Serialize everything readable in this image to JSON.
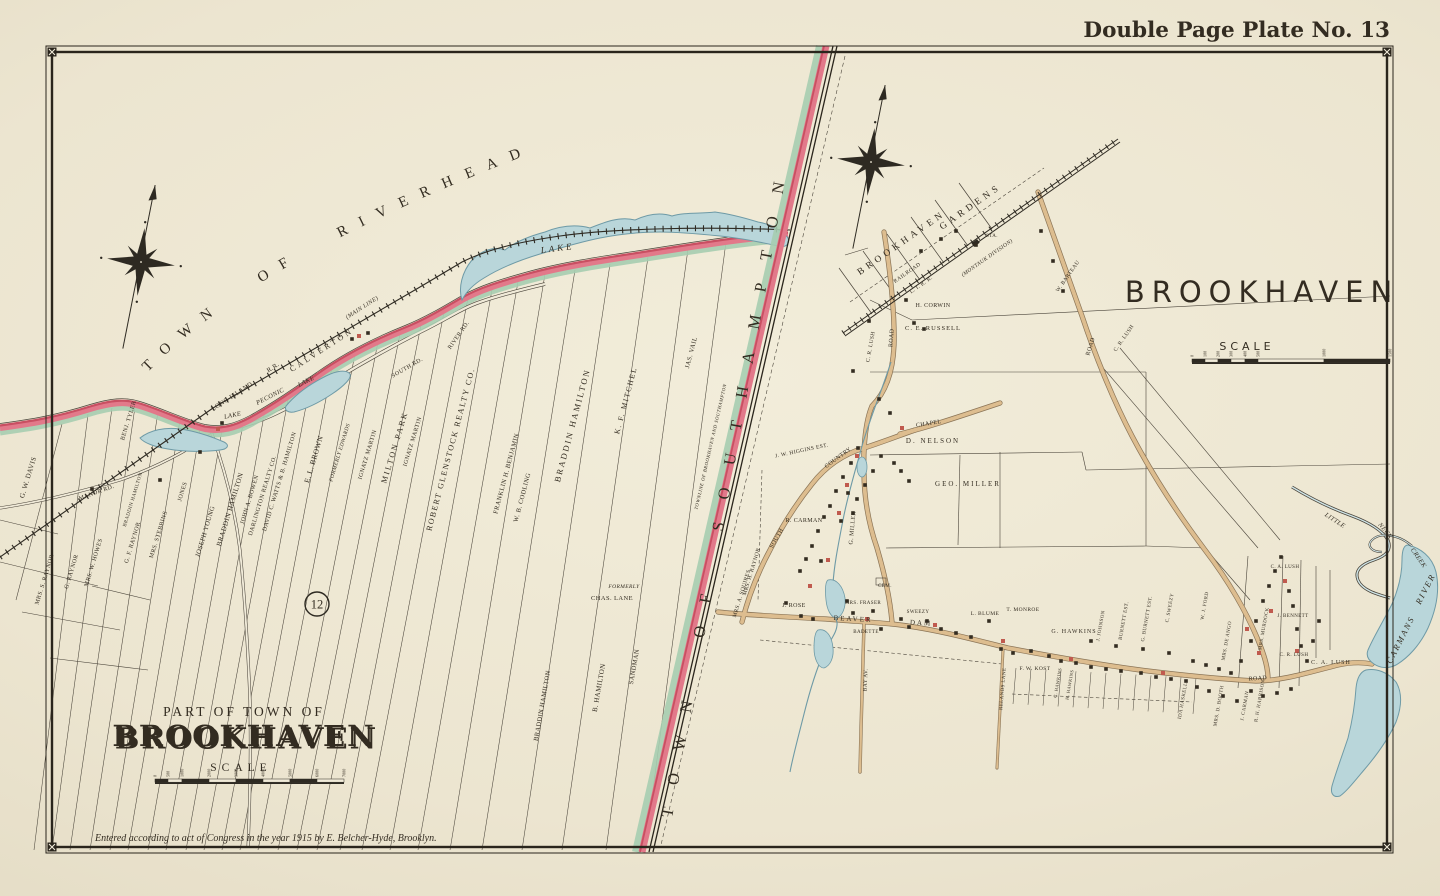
{
  "header": {
    "plate_title": "Double Page Plate No. 13"
  },
  "footer": {
    "copyright": "Entered according to act of Congress in the year 1915 by E. Belcher-Hyde, Brooklyn."
  },
  "colors": {
    "paper": "#ece5d1",
    "ink": "#332c21",
    "boundary_pink": "#e2798a",
    "boundary_crimson": "#c94f62",
    "boundary_green": "#a6cdb0",
    "water": "#b9d6da",
    "water_edge": "#6e9aa6",
    "road_tan": "#ddbd8f",
    "building_red": "#c05a4e"
  },
  "left_map": {
    "region_arc_title": "TOWN OF RIVERHEAD",
    "boundary_title": "TOWN OF SOUTHAMPTON",
    "boundary_note": "TOWNLINE OF BROOKHAVEN AND SOUTHAMPTON",
    "plate_ref": "12",
    "cartouche": {
      "prefix": "Part of Town of",
      "title": "BROOKHAVEN",
      "scale_label": "Scale"
    },
    "scale": {
      "y": 779,
      "ticks": [
        {
          "t": "0",
          "x": 155
        },
        {
          "t": "500",
          "x": 168
        },
        {
          "t": "1000",
          "x": 182
        },
        {
          "t": "2000",
          "x": 209
        },
        {
          "t": "3000",
          "x": 236
        },
        {
          "t": "4000",
          "x": 263
        },
        {
          "t": "5000",
          "x": 290
        },
        {
          "t": "6000",
          "x": 317
        },
        {
          "t": "7000",
          "x": 344
        }
      ]
    }
  },
  "right_map": {
    "title": "BROOKHAVEN",
    "scale_label": "Scale",
    "scale": {
      "y": 359,
      "ticks": [
        {
          "t": "0",
          "x": 1192
        },
        {
          "t": "100",
          "x": 1205
        },
        {
          "t": "200",
          "x": 1218
        },
        {
          "t": "300",
          "x": 1231
        },
        {
          "t": "400",
          "x": 1245
        },
        {
          "t": "500",
          "x": 1258
        },
        {
          "t": "1000",
          "x": 1324
        },
        {
          "t": "1500",
          "x": 1390
        }
      ]
    }
  },
  "map_labels": [
    {
      "t": "G. W. DAVIS",
      "x": 30,
      "y": 478,
      "r": -73,
      "s": 7
    },
    {
      "t": "BENJ. TYLER",
      "x": 130,
      "y": 421,
      "r": -73,
      "s": 6
    },
    {
      "t": "MANOR RD.",
      "x": 97,
      "y": 494,
      "r": -20,
      "s": 6
    },
    {
      "t": "MRS. S. RAYNOR",
      "x": 46,
      "y": 580,
      "r": -73,
      "s": 6
    },
    {
      "t": "G. RAYNOR",
      "x": 73,
      "y": 572,
      "r": -73,
      "s": 6
    },
    {
      "t": "MRS. W. HOWES",
      "x": 95,
      "y": 563,
      "r": -73,
      "s": 6
    },
    {
      "t": "G. F. RAYNOR",
      "x": 134,
      "y": 543,
      "r": -73,
      "s": 6
    },
    {
      "t": "BRADDIN HAMILTON",
      "x": 134,
      "y": 500,
      "r": -73,
      "s": 5
    },
    {
      "t": "MRS. STEBBINS",
      "x": 160,
      "y": 535,
      "r": -73,
      "s": 6
    },
    {
      "t": "JONES",
      "x": 184,
      "y": 492,
      "r": -73,
      "s": 6
    },
    {
      "t": "JOSEPH YOUNG",
      "x": 207,
      "y": 532,
      "r": -73,
      "s": 6.5
    },
    {
      "t": "BRADDIN HAMILTON",
      "x": 232,
      "y": 510,
      "r": -73,
      "s": 7
    },
    {
      "t": "JOHN A. BOWEN",
      "x": 251,
      "y": 500,
      "r": -73,
      "s": 6
    },
    {
      "t": "DARLINGTON REALTY CO.",
      "x": 264,
      "y": 496,
      "r": -73,
      "s": 6
    },
    {
      "t": "DAVID C. WATTS & B. HAMILTON",
      "x": 281,
      "y": 482,
      "r": -73,
      "s": 6
    },
    {
      "t": "E. L. BROWN",
      "x": 316,
      "y": 460,
      "r": -73,
      "s": 7.5
    },
    {
      "t": "FORMERLY EDWARDS",
      "x": 341,
      "y": 453,
      "r": -73,
      "s": 5.5,
      "c": "i"
    },
    {
      "t": "IGNATZ MARTIN",
      "x": 369,
      "y": 455,
      "r": -73,
      "s": 6
    },
    {
      "t": "MILTON PARK",
      "x": 397,
      "y": 448,
      "r": -73,
      "s": 8,
      "sp": 2
    },
    {
      "t": "IGNATZ MARTIN",
      "x": 414,
      "y": 442,
      "r": -73,
      "s": 6
    },
    {
      "t": "ROBERT GLENSTOCK REALTY CO.",
      "x": 453,
      "y": 450,
      "r": -75,
      "s": 8,
      "sp": 1.5
    },
    {
      "t": "FRANKLIN H. BENJAMIN",
      "x": 508,
      "y": 474,
      "r": -75,
      "s": 6.5
    },
    {
      "t": "W. B. CODLING",
      "x": 524,
      "y": 498,
      "r": -75,
      "s": 6.5
    },
    {
      "t": "BRADDIN HAMILTON",
      "x": 575,
      "y": 426,
      "r": -75,
      "s": 8.5,
      "sp": 2
    },
    {
      "t": "K. F. MITCHEL",
      "x": 628,
      "y": 401,
      "r": -75,
      "s": 7.5,
      "sp": 1.5
    },
    {
      "t": "JAS. VAIL",
      "x": 693,
      "y": 353,
      "r": -75,
      "s": 6.5
    },
    {
      "t": "LONG ISLAND",
      "x": 233,
      "y": 398,
      "r": -33,
      "s": 6.5
    },
    {
      "t": "R.R.",
      "x": 274,
      "y": 369,
      "r": -33,
      "s": 6.5
    },
    {
      "t": "(MAIN LINE)",
      "x": 363,
      "y": 309,
      "r": -33,
      "s": 6,
      "c": "i"
    },
    {
      "t": "CALVERTON",
      "x": 323,
      "y": 352,
      "r": -33,
      "s": 8,
      "sp": 3
    },
    {
      "t": "PECONIC",
      "x": 271,
      "y": 398,
      "r": -27,
      "s": 6.5,
      "c": "w"
    },
    {
      "t": "LAKE",
      "x": 307,
      "y": 383,
      "r": -27,
      "s": 6.5,
      "c": "w"
    },
    {
      "t": "LAKE",
      "x": 233,
      "y": 417,
      "r": -12,
      "s": 6.5,
      "c": "w"
    },
    {
      "t": "LAKE",
      "x": 558,
      "y": 251,
      "r": -7,
      "s": 9,
      "sp": 3,
      "c": "w"
    },
    {
      "t": "SOUTH RD.",
      "x": 408,
      "y": 369,
      "r": -30,
      "s": 6
    },
    {
      "t": "RIVER RD.",
      "x": 460,
      "y": 336,
      "r": -55,
      "s": 6
    },
    {
      "t": "FORMERLY",
      "x": 624,
      "y": 588,
      "r": 0,
      "s": 5.5,
      "c": "i"
    },
    {
      "t": "CHAS. LANE",
      "x": 612,
      "y": 600,
      "r": 0,
      "s": 6.5
    },
    {
      "t": "SANDMAN",
      "x": 636,
      "y": 667,
      "r": -80,
      "s": 6.5
    },
    {
      "t": "B. HAMILTON",
      "x": 601,
      "y": 688,
      "r": -80,
      "s": 7
    },
    {
      "t": "BRADDIN HAMILTON",
      "x": 544,
      "y": 706,
      "r": -80,
      "s": 6.5
    },
    {
      "t": "BROOKHAVEN",
      "x": 903,
      "y": 245,
      "r": -35,
      "s": 9.5,
      "sp": 4
    },
    {
      "t": "GARDENS",
      "x": 972,
      "y": 209,
      "r": -35,
      "s": 9.5,
      "sp": 4
    },
    {
      "t": "RAILROAD",
      "x": 908,
      "y": 274,
      "r": -35,
      "s": 5.5
    },
    {
      "t": "L. I. R. R.",
      "x": 922,
      "y": 286,
      "r": -35,
      "s": 5.5
    },
    {
      "t": "(MONTAUK DIVISION)",
      "x": 988,
      "y": 259,
      "r": -35,
      "s": 5.5,
      "c": "i"
    },
    {
      "t": "STA.",
      "x": 992,
      "y": 237,
      "r": 0,
      "s": 5
    },
    {
      "t": "W. BARTEAU",
      "x": 1069,
      "y": 277,
      "r": -55,
      "s": 5.5
    },
    {
      "t": "C. R. LUSH",
      "x": 1125,
      "y": 339,
      "r": -55,
      "s": 5.5
    },
    {
      "t": "H. CORWIN",
      "x": 933,
      "y": 307,
      "r": 0,
      "s": 6
    },
    {
      "t": "C. E. RUSSELL",
      "x": 933,
      "y": 330,
      "r": 0,
      "s": 6.5,
      "sp": 1
    },
    {
      "t": "C. R. LUSH",
      "x": 872,
      "y": 347,
      "r": -80,
      "s": 5.5
    },
    {
      "t": "ROAD",
      "x": 893,
      "y": 338,
      "r": -85,
      "s": 6
    },
    {
      "t": "ROAD",
      "x": 1092,
      "y": 347,
      "r": -72,
      "s": 6
    },
    {
      "t": "ROAD",
      "x": 1258,
      "y": 680,
      "r": -4,
      "s": 6
    },
    {
      "t": "COUNTRY",
      "x": 839,
      "y": 459,
      "r": -36,
      "s": 6
    },
    {
      "t": "SOUTH",
      "x": 778,
      "y": 539,
      "r": -60,
      "s": 6
    },
    {
      "t": "CHAPEL",
      "x": 929,
      "y": 425,
      "r": -9,
      "s": 6
    },
    {
      "t": "J. W. HIGGINS EST.",
      "x": 802,
      "y": 452,
      "r": -12,
      "s": 5.5
    },
    {
      "t": "D. NELSON",
      "x": 933,
      "y": 443,
      "r": 0,
      "s": 7,
      "sp": 2
    },
    {
      "t": "GEO. MILLER",
      "x": 968,
      "y": 486,
      "r": 0,
      "s": 7,
      "sp": 2
    },
    {
      "t": "G. MILLER",
      "x": 854,
      "y": 528,
      "r": -85,
      "s": 6
    },
    {
      "t": "R. CARMAN",
      "x": 804,
      "y": 522,
      "r": 0,
      "s": 6
    },
    {
      "t": "MRS. H. RAYNOR",
      "x": 753,
      "y": 572,
      "r": -73,
      "s": 5.5
    },
    {
      "t": "MRS. A. SQUIRES",
      "x": 743,
      "y": 594,
      "r": -73,
      "s": 5.5
    },
    {
      "t": "BEAVER",
      "x": 853,
      "y": 621,
      "r": 3,
      "s": 7,
      "sp": 2
    },
    {
      "t": "DAM",
      "x": 921,
      "y": 625,
      "r": 3,
      "s": 7,
      "sp": 2
    },
    {
      "t": "BAY AV.",
      "x": 867,
      "y": 680,
      "r": -88,
      "s": 5.5
    },
    {
      "t": "J. ROSE",
      "x": 794,
      "y": 607,
      "r": 0,
      "s": 6
    },
    {
      "t": "MRS. FRASER",
      "x": 863,
      "y": 604,
      "r": 0,
      "s": 5
    },
    {
      "t": "BADETTE",
      "x": 866,
      "y": 633,
      "r": 0,
      "s": 5
    },
    {
      "t": "SWEEZY",
      "x": 918,
      "y": 613,
      "r": 0,
      "s": 5
    },
    {
      "t": "CEM.",
      "x": 885,
      "y": 587,
      "r": 0,
      "s": 5
    },
    {
      "t": "L. BLUME",
      "x": 985,
      "y": 615,
      "r": 0,
      "s": 5.5
    },
    {
      "t": "T. MONROE",
      "x": 1023,
      "y": 611,
      "r": 0,
      "s": 5.5
    },
    {
      "t": "G. HAWKINS",
      "x": 1074,
      "y": 633,
      "r": 0,
      "s": 6,
      "sp": 1
    },
    {
      "t": "F. W. KOST",
      "x": 1035,
      "y": 670,
      "r": 0,
      "s": 5.5
    },
    {
      "t": "J. JOHNSON",
      "x": 1102,
      "y": 626,
      "r": -80,
      "s": 5
    },
    {
      "t": "BURNETT EST.",
      "x": 1125,
      "y": 621,
      "r": -80,
      "s": 5
    },
    {
      "t": "G. BURNETT EST.",
      "x": 1148,
      "y": 619,
      "r": -80,
      "s": 5
    },
    {
      "t": "C. SWEEZY",
      "x": 1171,
      "y": 608,
      "r": -80,
      "s": 5
    },
    {
      "t": "C. HAWKINS",
      "x": 1059,
      "y": 683,
      "r": -80,
      "s": 4.5
    },
    {
      "t": "H. HAWKINS",
      "x": 1071,
      "y": 685,
      "r": -80,
      "s": 4.5
    },
    {
      "t": "RELANDS LANE",
      "x": 1004,
      "y": 689,
      "r": -85,
      "s": 5
    },
    {
      "t": "IDA HASKELL",
      "x": 1184,
      "y": 701,
      "r": -80,
      "s": 5
    },
    {
      "t": "W. J. FORD",
      "x": 1206,
      "y": 606,
      "r": -80,
      "s": 5
    },
    {
      "t": "MRS. DE ANGO",
      "x": 1228,
      "y": 641,
      "r": -80,
      "s": 5
    },
    {
      "t": "MRS. D. BOOTH",
      "x": 1220,
      "y": 706,
      "r": -80,
      "s": 5
    },
    {
      "t": "J. CARMAN",
      "x": 1246,
      "y": 706,
      "r": -80,
      "s": 5
    },
    {
      "t": "R. H. HARRISON",
      "x": 1261,
      "y": 701,
      "r": -80,
      "s": 5
    },
    {
      "t": "MRS. MURDOCK",
      "x": 1265,
      "y": 629,
      "r": -80,
      "s": 5
    },
    {
      "t": "J. BENNETT",
      "x": 1293,
      "y": 617,
      "r": 0,
      "s": 5
    },
    {
      "t": "C. R. LUSH",
      "x": 1294,
      "y": 656,
      "r": 0,
      "s": 5
    },
    {
      "t": "C. A. LUSH",
      "x": 1285,
      "y": 568,
      "r": 0,
      "s": 5
    },
    {
      "t": "C. A. LUSH",
      "x": 1331,
      "y": 664,
      "r": 0,
      "s": 6,
      "sp": 1
    },
    {
      "t": "LITTLE",
      "x": 1334,
      "y": 522,
      "r": 33,
      "s": 6.5,
      "c": "w"
    },
    {
      "t": "NECK",
      "x": 1384,
      "y": 532,
      "r": 50,
      "s": 6.5,
      "c": "w"
    },
    {
      "t": "CREEK",
      "x": 1417,
      "y": 559,
      "r": 55,
      "s": 6.5,
      "c": "w"
    },
    {
      "t": "CARMANS",
      "x": 1403,
      "y": 641,
      "r": -63,
      "s": 8.5,
      "sp": 2,
      "c": "w"
    },
    {
      "t": "RIVER",
      "x": 1428,
      "y": 590,
      "r": -63,
      "s": 8.5,
      "sp": 2,
      "c": "w"
    }
  ]
}
